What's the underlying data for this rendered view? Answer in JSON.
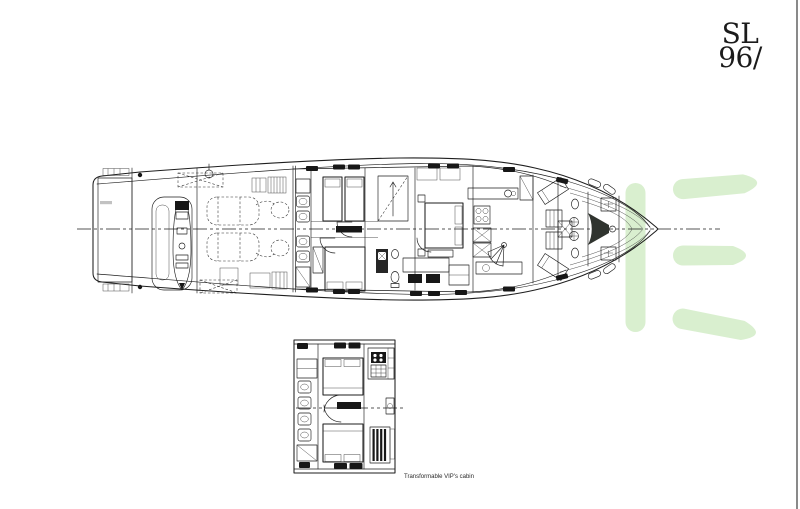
{
  "brand": {
    "model_line1": "SL",
    "model_line2": "96/"
  },
  "captions": {
    "detail_plan": "Transformable VIP's cabin"
  },
  "colors": {
    "background": "#ffffff",
    "ink": "#1e1e1e",
    "watermark_green": "#d9efcf",
    "page_edge": "#4a4a4a"
  }
}
